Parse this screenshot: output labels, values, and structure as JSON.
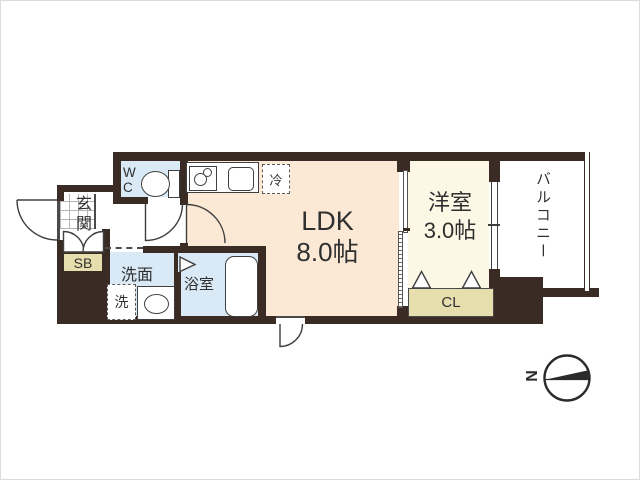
{
  "floor_plan": {
    "rooms": {
      "ldk": {
        "name": "LDK",
        "size": "8.0帖"
      },
      "bedroom": {
        "name": "洋室",
        "size": "3.0帖"
      },
      "entrance": {
        "label": "玄関"
      },
      "wc": {
        "line1": "W",
        "line2": "C"
      },
      "washroom": {
        "label": "洗面"
      },
      "washing_machine": {
        "label": "洗"
      },
      "bathroom": {
        "label": "浴室"
      },
      "refrigerator": {
        "label": "冷"
      },
      "shoe_box": {
        "label": "SB"
      },
      "closet": {
        "label": "CL"
      },
      "balcony": {
        "label": "バルコニー"
      }
    },
    "compass": {
      "north": "N"
    },
    "colors": {
      "wall": "#3a2c25",
      "ldk": "#fbe8d5",
      "bedroom": "#fdf8e6",
      "wet": "#d9eaf6",
      "storage": "#e7deae",
      "line": "#3f3f3f",
      "text": "#2f2f2f"
    }
  }
}
